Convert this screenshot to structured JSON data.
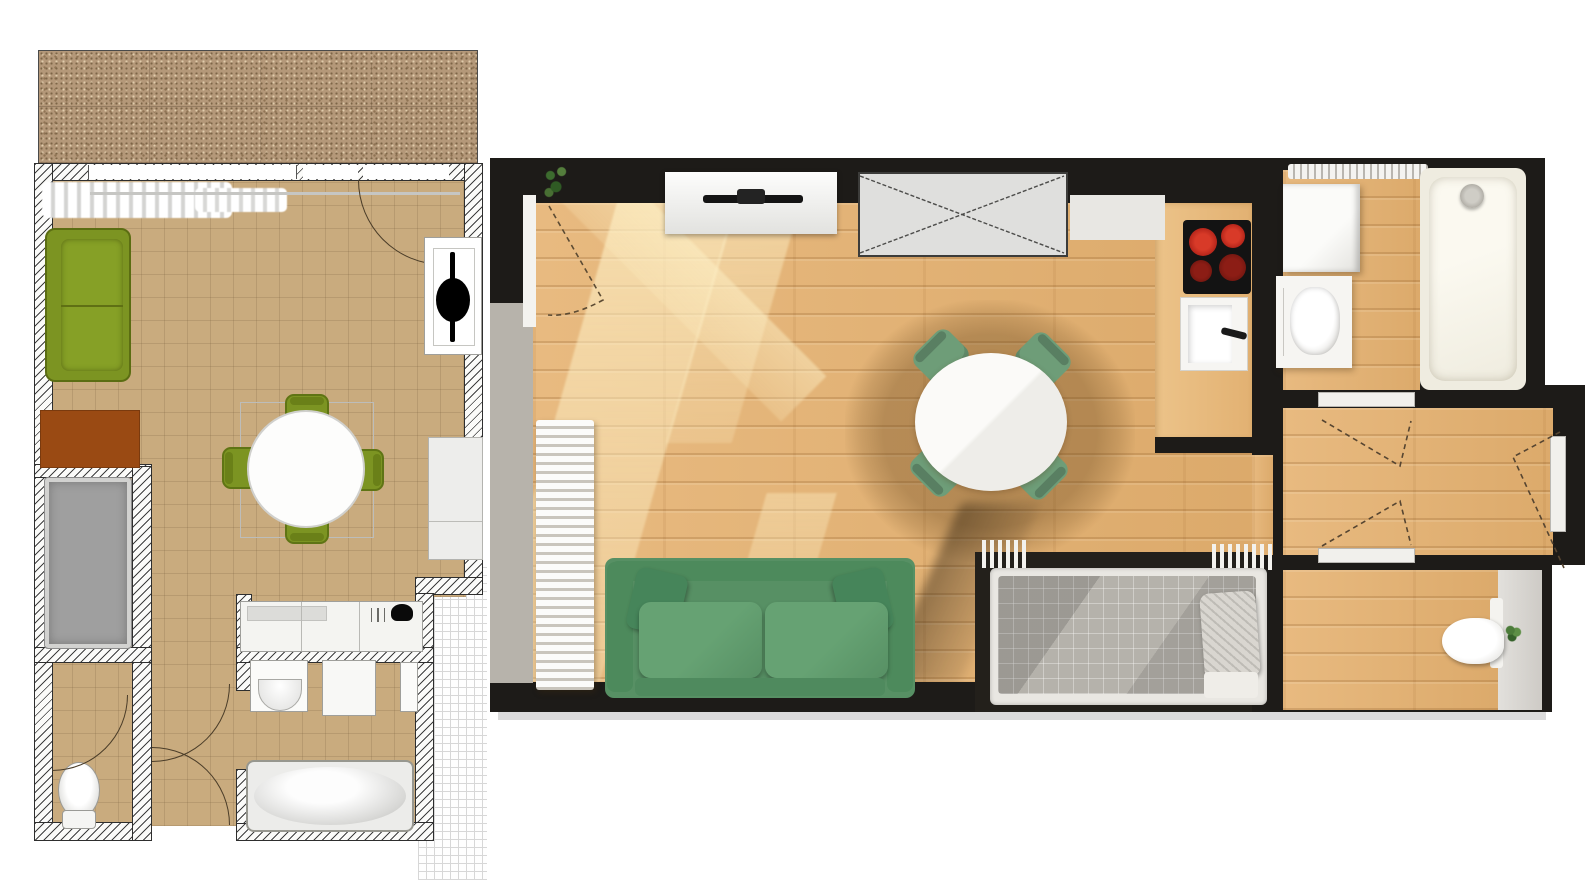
{
  "page": {
    "label": "Apartment floor plan: 2D architectural drawing beside 3D top-down render",
    "background": "#ffffff"
  },
  "plan2d": {
    "label": "2D architectural floor plan with terrace",
    "colors": {
      "floor": "#c9ab7e",
      "terrace": "#b49879",
      "wall": "#ffffff",
      "sofa": "#7c9422",
      "chair": "#7c9422",
      "rug": "#9a4a13",
      "bed": "#9e9e9e",
      "fixtures": "#f6f6f4",
      "tv": "#000000"
    },
    "rooms": [
      "terrace",
      "living-room",
      "sleeping-niche",
      "open-kitchen",
      "hallway",
      "wc",
      "bathroom"
    ],
    "furniture": [
      "sofa",
      "rug",
      "bed",
      "round-dining-table",
      "dining-chairs-x4",
      "tv-sideboard",
      "wardrobe",
      "kitchen-counter",
      "sink-symbol",
      "hob-symbol",
      "toilet",
      "washbasin",
      "washing-machine",
      "bathtub",
      "radiator-row",
      "window-band",
      "door-swing-arcs"
    ]
  },
  "render3d": {
    "label": "3D rendered top-down view of the same apartment",
    "colors": {
      "wall": "#1d1b18",
      "floor": "#e4b377",
      "sofa": "#579064",
      "chair": "#6e9d78",
      "table": "#f7f6f3",
      "burner_hot": "#c6291f",
      "burner_dim": "#7c1a16",
      "blanket": "#b5b2ab",
      "tub": "#f3f0e4",
      "plant": "#4c7c3a",
      "window_sill": "#b7b3ab"
    },
    "rooms": [
      "living-room",
      "kitchen-nook",
      "bathroom",
      "hallway",
      "wc"
    ],
    "furniture": [
      "tv-console",
      "wall-tv",
      "planned-wardrobe-crossed-box",
      "cooktop-4-burners",
      "kitchen-sink",
      "round-dining-table",
      "dining-chairs-x4",
      "green-sofa",
      "window-radiator",
      "double-bed",
      "bathtub-with-shower",
      "washing-machine",
      "vanity-washbasin",
      "bathroom-radiator",
      "toilet",
      "potted-plant",
      "entry-door",
      "interior-door-swings"
    ]
  }
}
